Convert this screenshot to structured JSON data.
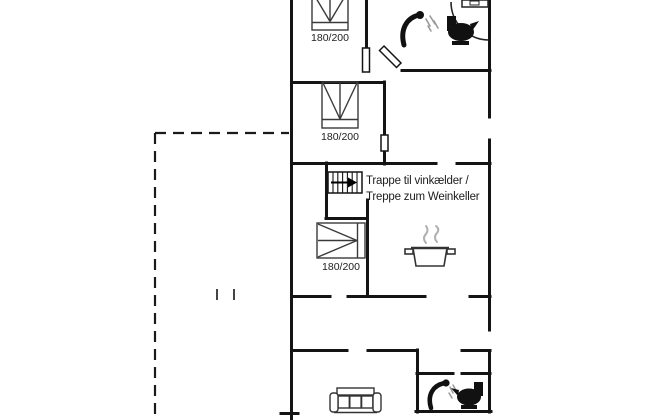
{
  "floor_plan": {
    "background_color": "#ffffff",
    "wall_color": "#141414",
    "line_color": "#3a3a3a",
    "text_color": "#1d1d1d",
    "steam_color": "#b0b0b0",
    "beds": [
      {
        "room": "bedroom-top",
        "size_label": "180/200"
      },
      {
        "room": "bedroom-middle",
        "size_label": "180/200"
      },
      {
        "room": "bedroom-lower",
        "size_label": "180/200"
      }
    ],
    "staircase_note": {
      "line1": "Trappe til vinkælder /",
      "line2": "Treppe zum Weinkeller"
    },
    "icons": [
      "staircase-icon",
      "shower-icon",
      "toilet-icon",
      "sink-icon",
      "door-swing-arc",
      "cooking-pot-icon",
      "sofa-icon",
      "terrace-outline"
    ]
  }
}
